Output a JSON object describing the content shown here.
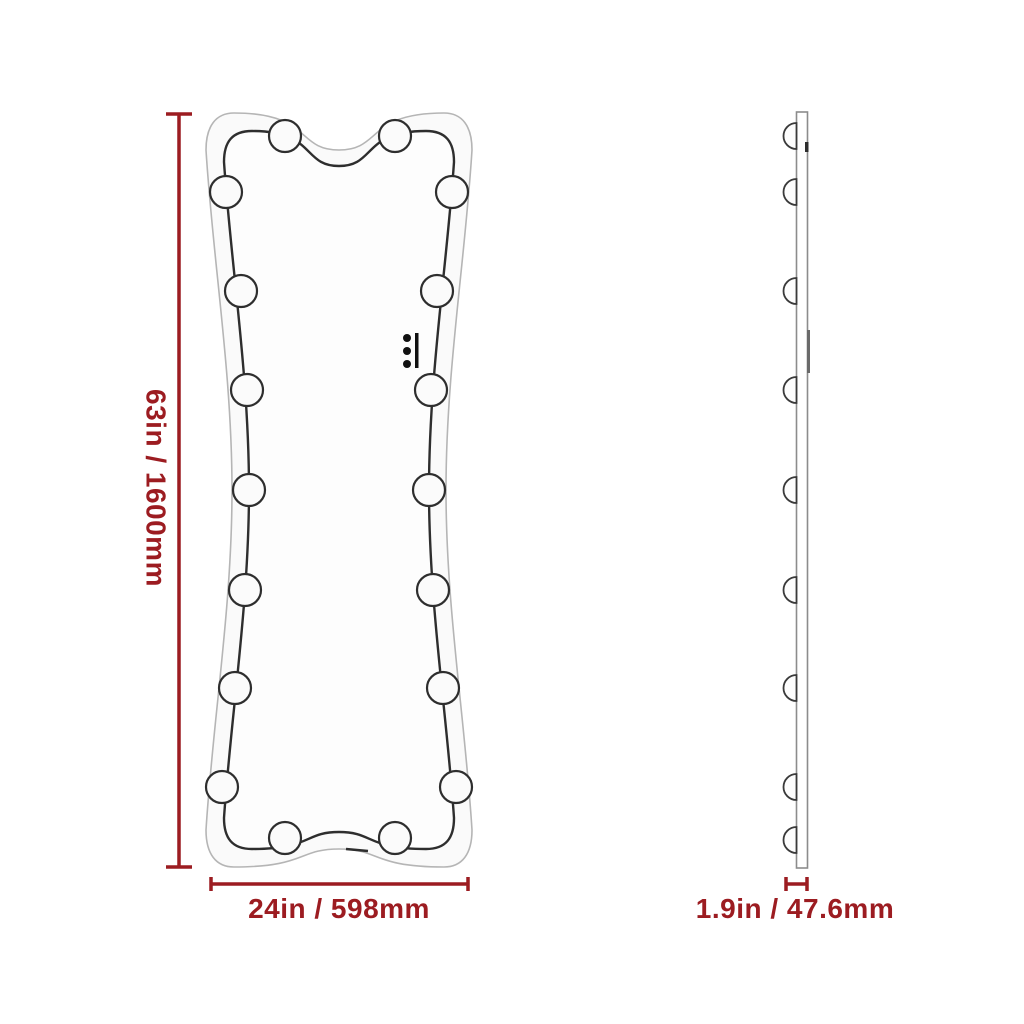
{
  "colors": {
    "dimension_red": "#9c1c21",
    "outline_dark": "#2e2e2e",
    "outline_light": "#b5b5b5",
    "side_outline": "#8c8c8c"
  },
  "dimensions": {
    "height": {
      "label": "63in / 1600mm"
    },
    "width": {
      "label": "24in / 598mm"
    },
    "depth": {
      "label": "1.9in / 47.6mm"
    }
  },
  "front_view": {
    "bulb_count": 18,
    "control_dot_count": 3
  },
  "side_view": {
    "bulb_count": 9
  }
}
